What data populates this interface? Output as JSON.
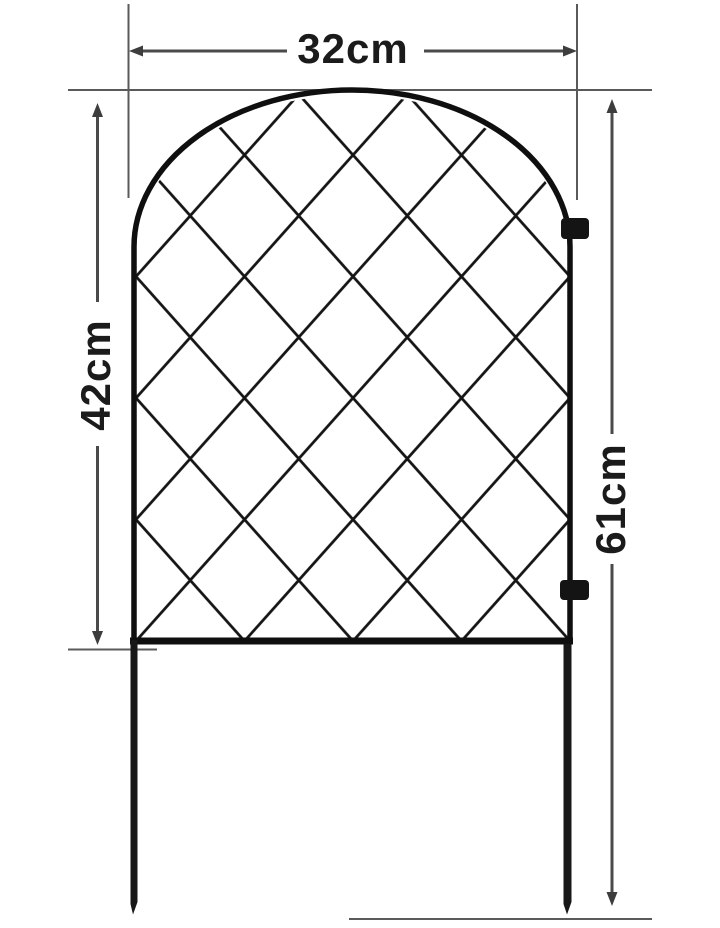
{
  "diagram": {
    "type": "product-dimension-diagram",
    "subject": "arched garden border fence panel with diamond lattice and ground stakes",
    "labels": {
      "width": "32cm",
      "panel_height": "42cm",
      "overall_height": "61cm"
    },
    "features": {
      "lattice": "diamond wire grid",
      "top": "arched",
      "stakes": 2,
      "connector_clips": 2
    },
    "colors": {
      "background": "#ffffff",
      "fence": "#101010",
      "dimension_lines": "#4f4f4f",
      "label_text": "#1b1b1b"
    }
  }
}
